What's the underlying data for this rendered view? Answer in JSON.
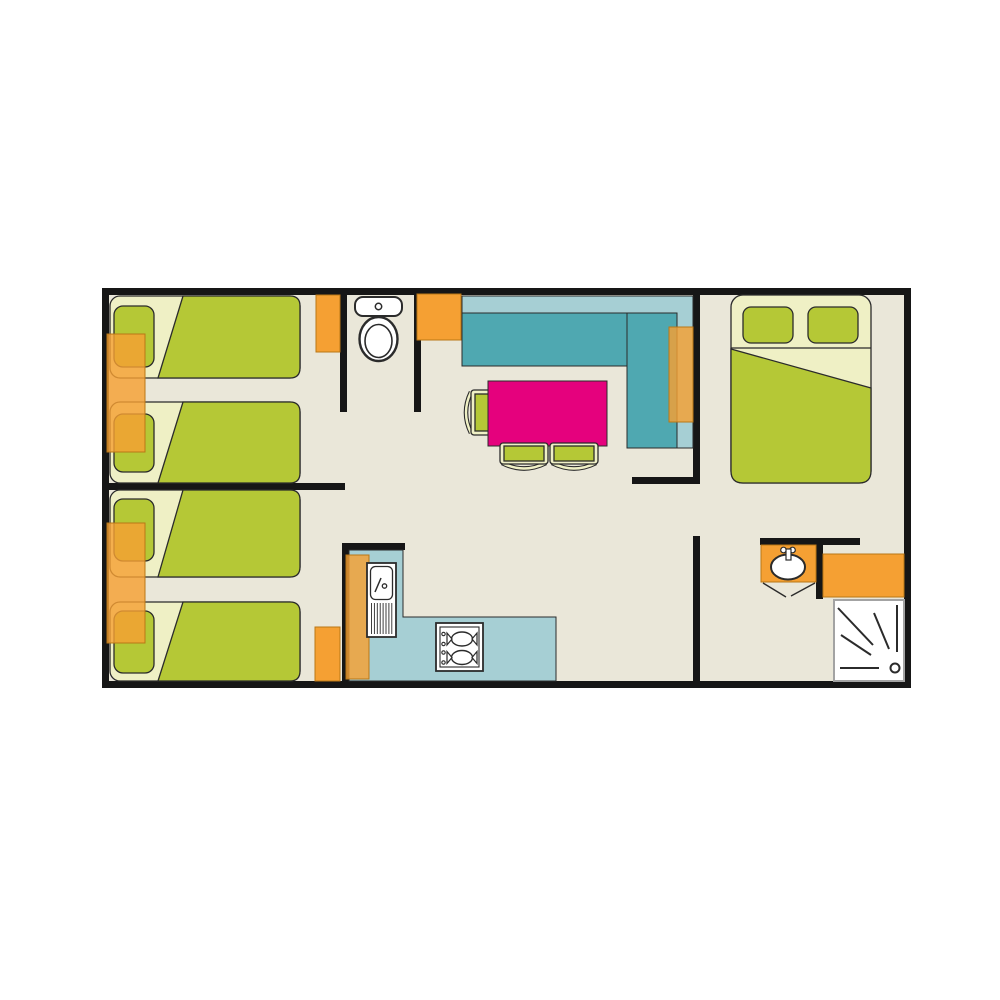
{
  "palette": {
    "floor": "#EAE7D9",
    "wall": "#161616",
    "outline": "#2B2B2B",
    "green": "#B5C836",
    "green-light": "#EFF0C5",
    "orange": "#F5A033",
    "orange-edge": "#B97716",
    "teal": "#4FA8B1",
    "teal-light": "#A6CFD4",
    "pink": "#E5017D",
    "white": "#FFFFFF",
    "shower-border": "#A3A3A3"
  },
  "floor_plan": {
    "kind": "mobile-home floor plan, schematic top view, no text labels",
    "rooms": [
      {
        "name": "bedroom-twin-top-left",
        "furniture": [
          "single-bed",
          "single-bed",
          "nightstand",
          "wardrobe"
        ]
      },
      {
        "name": "bedroom-twin-bottom-left",
        "furniture": [
          "single-bed",
          "single-bed",
          "nightstand",
          "wardrobe"
        ]
      },
      {
        "name": "wc",
        "furniture": [
          "toilet"
        ]
      },
      {
        "name": "living-dining",
        "furniture": [
          "corner-sofa",
          "sofa-side-panel",
          "sideboard",
          "dining-table",
          "chair",
          "chair",
          "chair"
        ]
      },
      {
        "name": "kitchen",
        "furniture": [
          "l-shaped-counter",
          "tall-cabinet",
          "sink-with-drainer",
          "two-burner-hob"
        ]
      },
      {
        "name": "bedroom-double-right",
        "furniture": [
          "double-bed"
        ]
      },
      {
        "name": "shower-room",
        "furniture": [
          "washbasin",
          "cabinet",
          "shower"
        ]
      }
    ]
  }
}
